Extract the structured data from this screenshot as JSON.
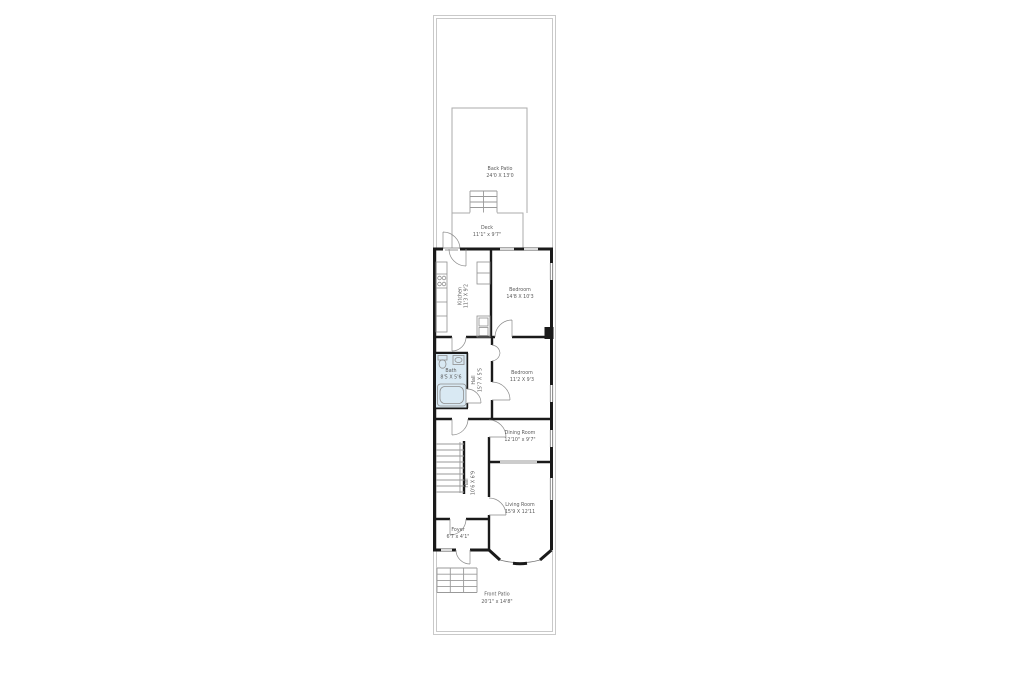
{
  "plan": {
    "colors": {
      "wall": "#1a1a1a",
      "boundary": "#c9c9c9",
      "fixture": "#8f8f8f",
      "label": "#5a5a5a",
      "bath_fill": "#d9e9f3"
    },
    "rooms": {
      "back_patio": {
        "name": "Back Patio",
        "dims": "24'0 X 13'0"
      },
      "deck": {
        "name": "Deck",
        "dims": "11'1\" x 9'7\""
      },
      "kitchen": {
        "name": "Kitchen",
        "dims": "11'3 X 9'2"
      },
      "bedroom_1": {
        "name": "Bedroom",
        "dims": "14'8 X 10'3"
      },
      "bath": {
        "name": "Bath",
        "dims": "8'5 X 5'6"
      },
      "hall_upper": {
        "name": "Hall",
        "dims": "15'7 X 5'5"
      },
      "bedroom_2": {
        "name": "Bedroom",
        "dims": "11'2 X 9'3"
      },
      "dining_room": {
        "name": "Dining Room",
        "dims": "12'10\" x 9'7\""
      },
      "hall_lower": {
        "name": "Hall",
        "dims": "10'6 X 6'9"
      },
      "living_room": {
        "name": "Living Room",
        "dims": "15'9 X 12'11"
      },
      "foyer": {
        "name": "Foyer",
        "dims": "6'7 x 4'1\""
      },
      "front_patio": {
        "name": "Front Patio",
        "dims": "20'1\" x 14'8\""
      }
    }
  }
}
